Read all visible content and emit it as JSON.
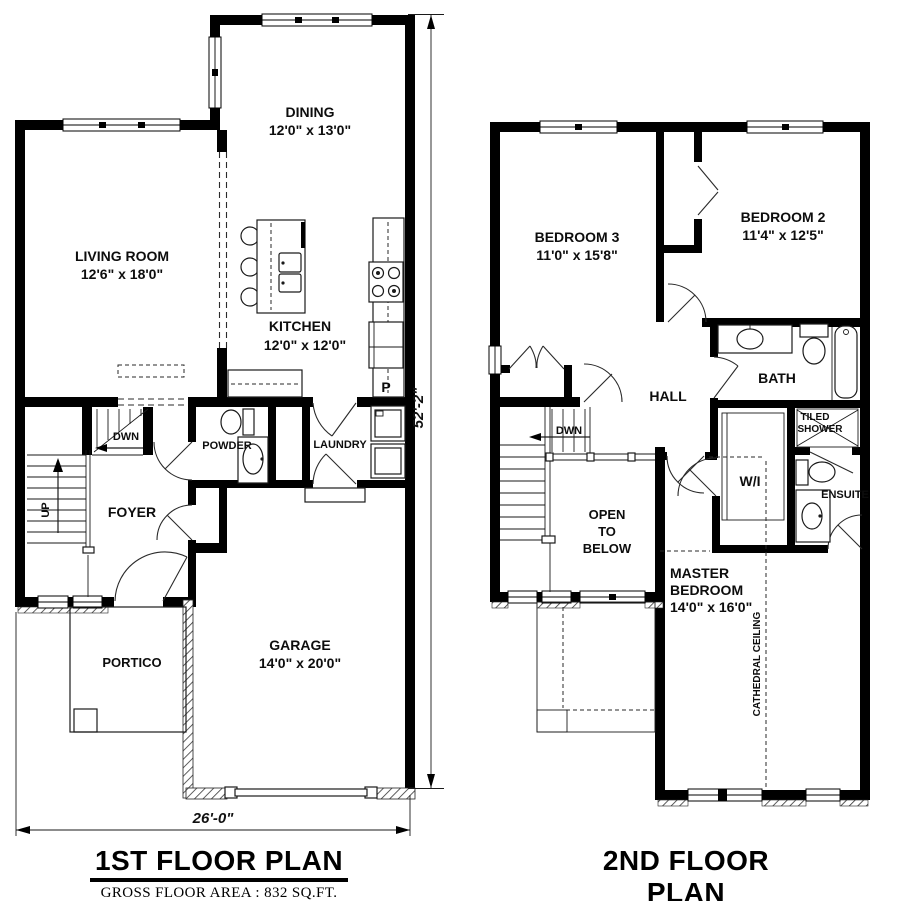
{
  "colors": {
    "ink": "#000000",
    "paper": "#ffffff",
    "fixture_line": "#1a1a1a"
  },
  "floor1": {
    "title": "1ST FLOOR PLAN",
    "area": "GROSS FLOOR AREA : 832 SQ.FT.",
    "dim_width": "26'-0\"",
    "dim_height": "52'-2\"",
    "rooms": {
      "living": {
        "name": "LIVING ROOM",
        "dims": "12'6\" x 18'0\""
      },
      "dining": {
        "name": "DINING",
        "dims": "12'0\" x 13'0\""
      },
      "kitchen": {
        "name": "KITCHEN",
        "dims": "12'0\" x 12'0\""
      },
      "garage": {
        "name": "GARAGE",
        "dims": "14'0\" x 20'0\""
      },
      "powder": {
        "name": "POWDER"
      },
      "laundry": {
        "name": "LAUNDRY"
      },
      "foyer": {
        "name": "FOYER"
      },
      "portico": {
        "name": "PORTICO"
      },
      "pantry": {
        "name": "P"
      }
    },
    "stairs": {
      "up": "UP",
      "down": "DWN"
    }
  },
  "floor2": {
    "title": "2ND FLOOR PLAN",
    "area": "GROSS FLOOR AREA : 898 SQ.FT.",
    "rooms": {
      "bedroom3": {
        "name": "BEDROOM 3",
        "dims": "11'0\" x 15'8\""
      },
      "bedroom2": {
        "name": "BEDROOM 2",
        "dims": "11'4\" x 12'5\""
      },
      "master": {
        "line1": "MASTER",
        "line2": "BEDROOM",
        "dims": "14'0\" x 16'0\""
      },
      "bath": {
        "name": "BATH"
      },
      "ensuite": {
        "name": "ENSUITE"
      },
      "shower": {
        "line1": "TILED",
        "line2": "SHOWER"
      },
      "wic": {
        "name": "W/I"
      },
      "hall": {
        "name": "HALL"
      },
      "open": {
        "line1": "OPEN",
        "line2": "TO",
        "line3": "BELOW"
      },
      "cathedral": "CATHEDRAL CEILING"
    },
    "stairs": {
      "down": "DWN"
    }
  }
}
